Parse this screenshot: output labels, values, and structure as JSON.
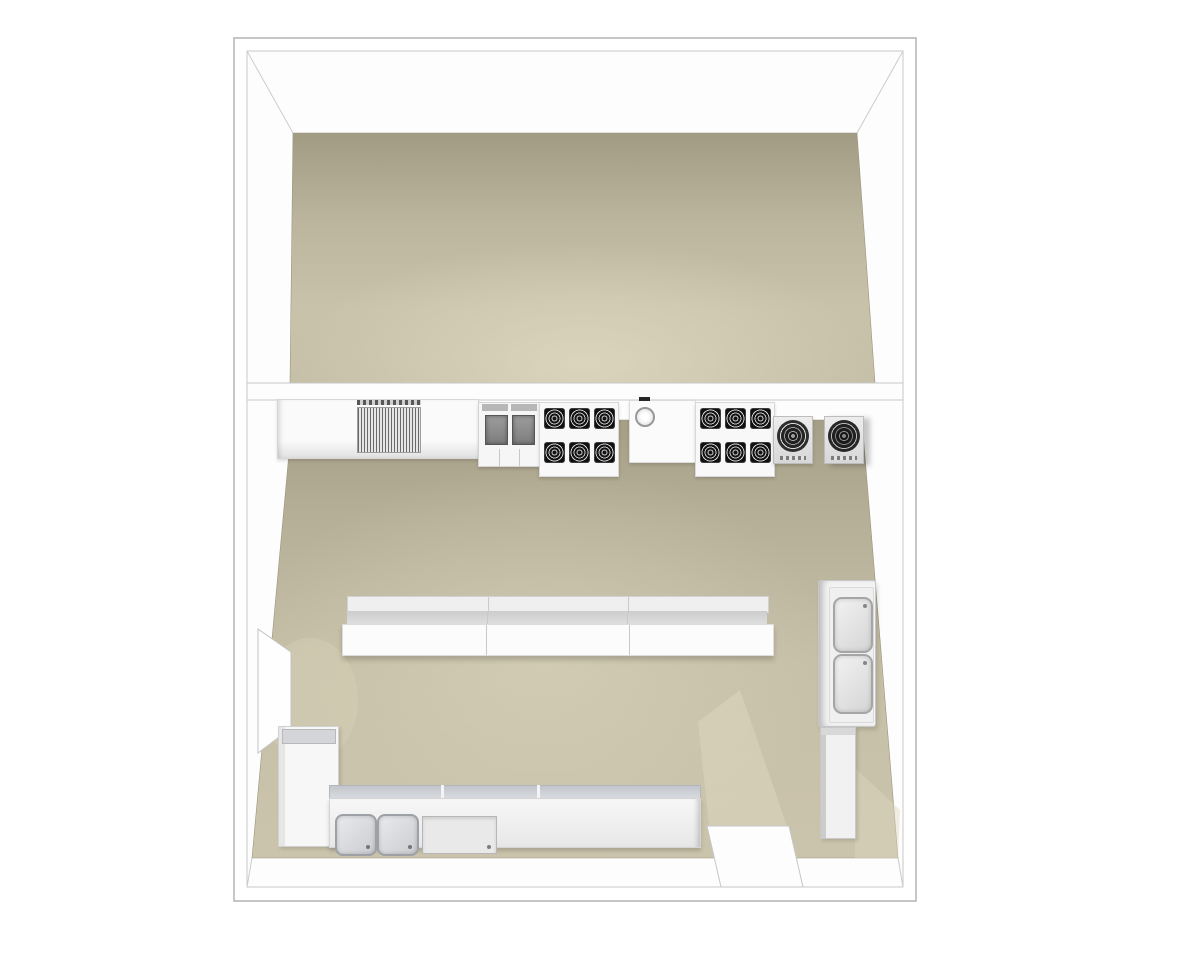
{
  "meta": {
    "kind": "3d-floorplan-render",
    "view": "top-down-perspective",
    "text_visible": false
  },
  "palette": {
    "background": "#ffffff",
    "wall_fill": "#fdfdfd",
    "wall_line": "#b3b3b3",
    "wall_line_light": "#cccccc",
    "floor_upper_dark": "#a29b83",
    "floor_upper_light": "#cdc6ae",
    "floor_kitchen_dark": "#a59e86",
    "floor_kitchen_light": "#cbc4ac",
    "floor_highlight": "#ded8c0",
    "equipment_white": "#f7f7f7",
    "steel_mid": "#d7d7d7",
    "burner_dark": "#141414",
    "burner_ring": "#d2d2d2",
    "fryer_vat": "#8a8a8a",
    "griddle_stripe": "#6a6a6a",
    "sink_fill": "#d9dbde",
    "sink_border": "#a0a4a9"
  },
  "building": {
    "rooms": [
      {
        "name": "upper-room",
        "contents": []
      },
      {
        "name": "kitchen",
        "contents": [
          "wall-counter",
          "charbroiler-griddle",
          "double-basket-fryer",
          "six-burner-range-left",
          "hand-sink-prep-table",
          "six-burner-range-right",
          "stock-pot-burner-left",
          "stock-pot-burner-right",
          "three-section-prep-island",
          "two-basin-tall-sink-unit",
          "lowboy-cabinet",
          "l-shaped-counter",
          "double-compartment-sink",
          "soak-sink",
          "door-opening-left-wall",
          "door-opening-bottom-wall"
        ]
      }
    ]
  }
}
